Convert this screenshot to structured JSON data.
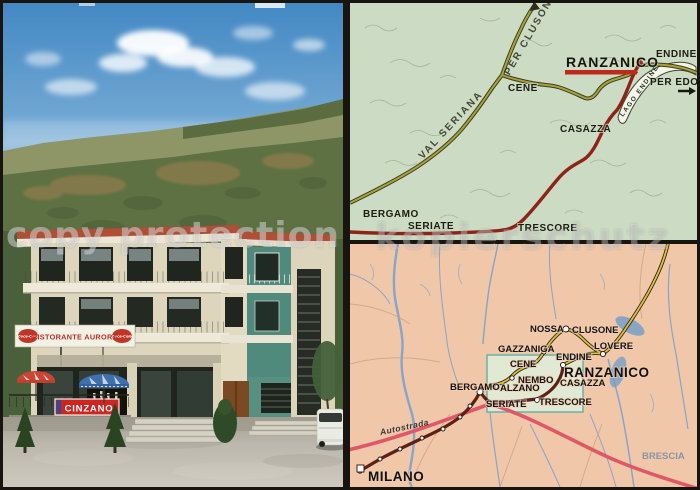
{
  "watermark": {
    "left": "copy protection",
    "right": "kopierschutz"
  },
  "photo": {
    "restaurant_sign": "RISTORANTE AURORA",
    "coke_logo": "Coca-Cola",
    "cinzano_sign": "CINZANO"
  },
  "map_top": {
    "ranzanico": "RANZANICO",
    "endine": "ENDINE",
    "per_edolo": "PER EDOLO",
    "cene": "CENE",
    "casazza": "CASAZZA",
    "bergamo": "BERGAMO",
    "seriate": "SERIATE",
    "trescore": "TRESCORE",
    "val_seriana": "VAL SERIANA",
    "per_clusone": "PER CLUSONE",
    "lago_endine": "LAGO ENDINE"
  },
  "map_bottom": {
    "milano": "MILANO",
    "autostrada": "Autostrada",
    "bergamo": "BERGAMO",
    "seriate": "SERIATE",
    "trescore": "TRESCORE",
    "alzano": "ALZANO",
    "nembo": "NEMBO",
    "cene": "CENE",
    "gazzaniga": "GAZZANIGA",
    "nossa": "NOSSA",
    "clusone": "CLUSONE",
    "lovere": "LOVERE",
    "endine": "ENDINE",
    "ranzanico": "RANZANICO",
    "casazza": "CASAZZA",
    "brescia": "BRESCIA"
  },
  "colors": {
    "map_top_bg": "#ccdbc3",
    "map_bottom_bg": "#f0c7a9",
    "red_road": "#8c2418",
    "olive_road": "#a8a23c",
    "yellow_road": "#e0c040",
    "maroon_road": "#5e2014",
    "autostrada_line": "#e05868",
    "river": "#7ba2cc",
    "highlight_box": "#dff0dc",
    "ranzanico_underline": "#c0281c",
    "cinzano_red": "#cf2521",
    "coke_red": "#c13526",
    "teal_wall": "#4f8a7c"
  }
}
